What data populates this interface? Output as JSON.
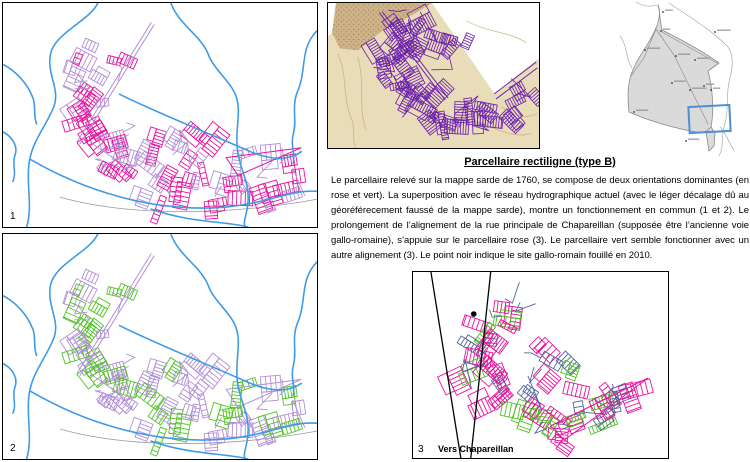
{
  "document": {
    "title": "Parcellaire rectiligne (type B)",
    "body": "Le parcellaire relevé sur la mappe sarde de 1760, se compose de deux orientations dominantes (en rose et vert). La superposition avec le réseau hydrographique actuel (avec le léger décalage dû au géoréférecement faussé de la mappe sarde), montre un fonctionnement en commun (1 et 2). Le prolongement de l’alignement de la rue principale de Chapareillan (supposée être l’ancienne voie gallo-romaine), s’appuie sur le parcellaire rose (3). Le parcellaire vert semble fonctionner avec un autre alignement (3). Le point noir indique le site gallo-romain fouillé en 2010."
  },
  "panels": {
    "map1": {
      "label": "1"
    },
    "map2": {
      "label": "2"
    },
    "map3": {
      "label": "3",
      "caption": "Vers Chapareillan"
    }
  },
  "colors": {
    "rose": "#e8119b",
    "lavender": "#b18ed6",
    "green": "#4cc41e",
    "river": "#3d9ae8",
    "slate": "#54659c",
    "sarde_purple": "#6d22ad",
    "sarde_bg": "#e9dcb8",
    "sarde_mountain": "#c6a678",
    "sarde_speckle": "#7e5f38",
    "sarde_contour": "#cdb488",
    "region_fill": "#dadada",
    "region_stroke": "#8a8a8a",
    "region_box": "#4f8fd4",
    "road_gray": "#999999",
    "black": "#000000"
  }
}
